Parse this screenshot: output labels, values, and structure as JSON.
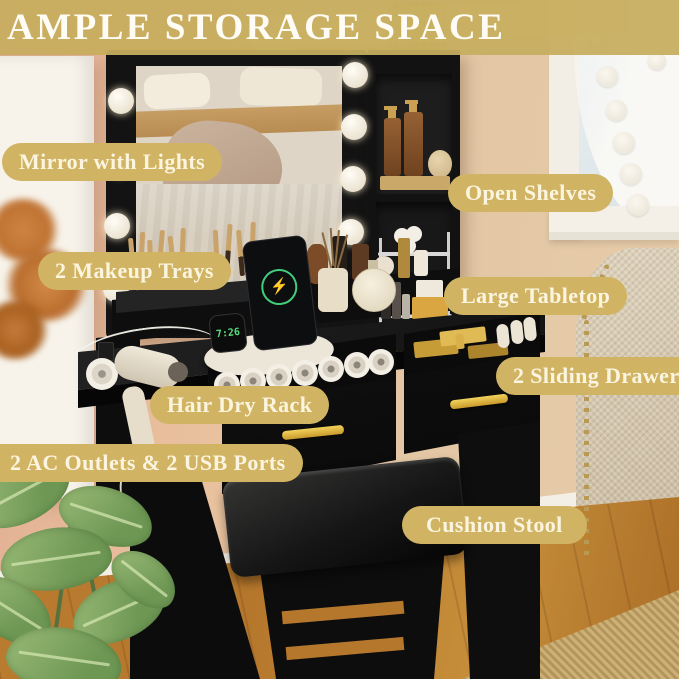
{
  "banner": {
    "title": "AMPLE STORAGE SPACE"
  },
  "labels": {
    "mirror": "Mirror with Lights",
    "shelves": "Open Shelves",
    "trays": "2 Makeup Trays",
    "tabletop": "Large Tabletop",
    "drawers": "2 Sliding Drawers",
    "hair_rack": "Hair Dry Rack",
    "outlets": "2 AC Outlets & 2 USB Ports",
    "stool": "Cushion Stool"
  },
  "device": {
    "watch_time": "7:26",
    "charge_icon": "⚡"
  },
  "colors": {
    "annotation_gold": "#d1b463",
    "banner_gold": "#c7ad5f",
    "label_text": "#fbf4df",
    "vanity_black": "#121212",
    "handle_gold": "#e2b33c",
    "floor_wood": "#b5772c",
    "wall_pink": "#e2ae94",
    "wall_tan": "#e3c7a5",
    "plant_green": "#7ea35f"
  }
}
